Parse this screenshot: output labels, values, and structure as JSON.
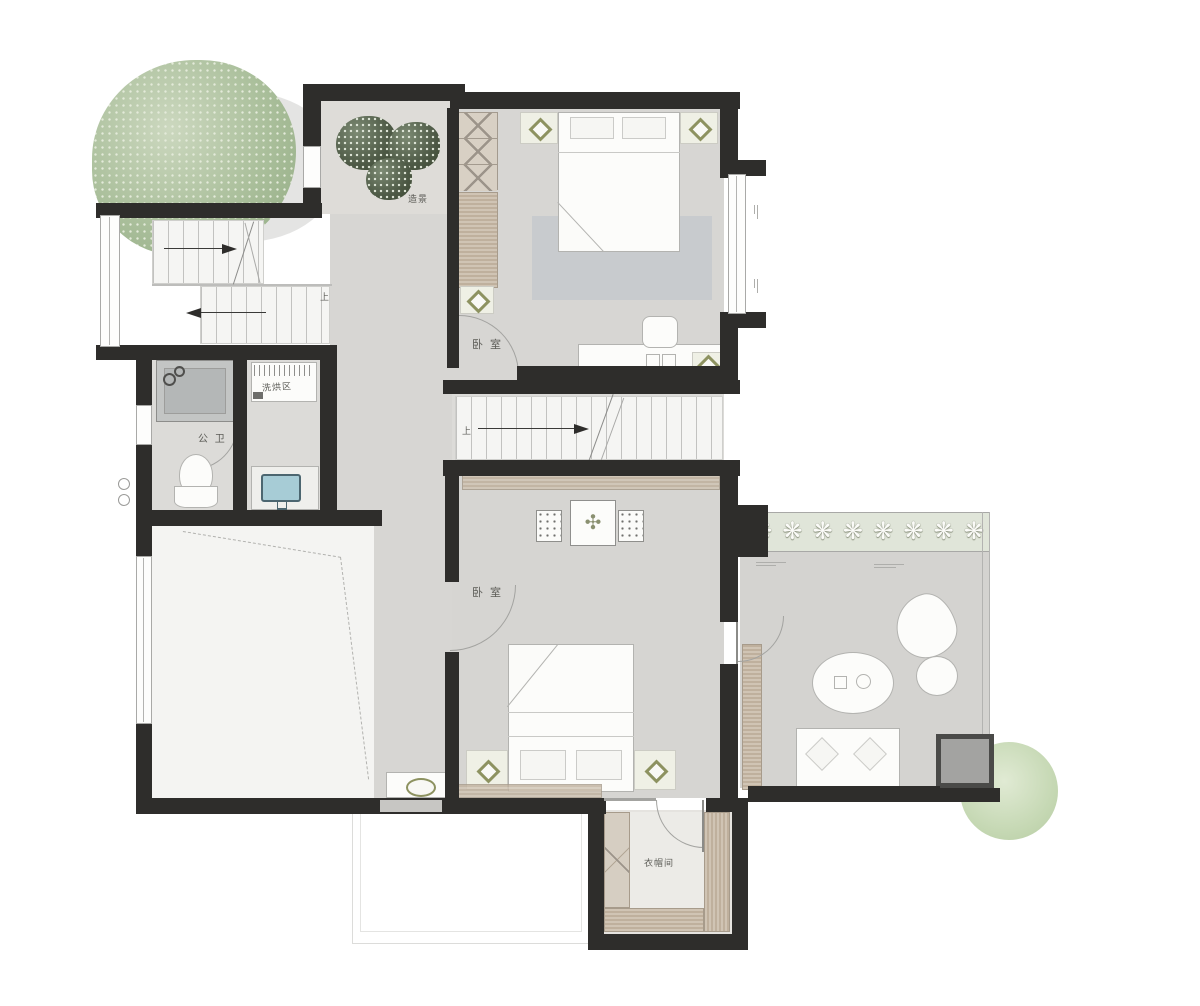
{
  "title": "Residential upper-floor furniture plan",
  "labels": {
    "landscape": "造景",
    "bedroom_top": "卧 室",
    "bedroom_bottom": "卧 室",
    "bathroom": "公 卫",
    "laundry": "洗烘区",
    "closet": "衣帽间",
    "stair_up_left": "上",
    "stair_up_mid": "上"
  },
  "icons": {
    "planter_flower": "❋",
    "dresser_plant": "✣"
  },
  "colors": {
    "wall": "#2e2d2b",
    "floor": "#d7d6d3",
    "floor_light": "#e3e2df",
    "void_white": "#f4f4f2",
    "rug": "#c6c9cc",
    "wood": "#cfc6ba",
    "wood_dark": "#bfb09d",
    "tree_green": "#aabf9b",
    "bush_green": "#4e5a46",
    "planter_green": "#e0e5d9",
    "basin_blue": "#a7ccd6",
    "lamp_olive": "#8d9260"
  }
}
